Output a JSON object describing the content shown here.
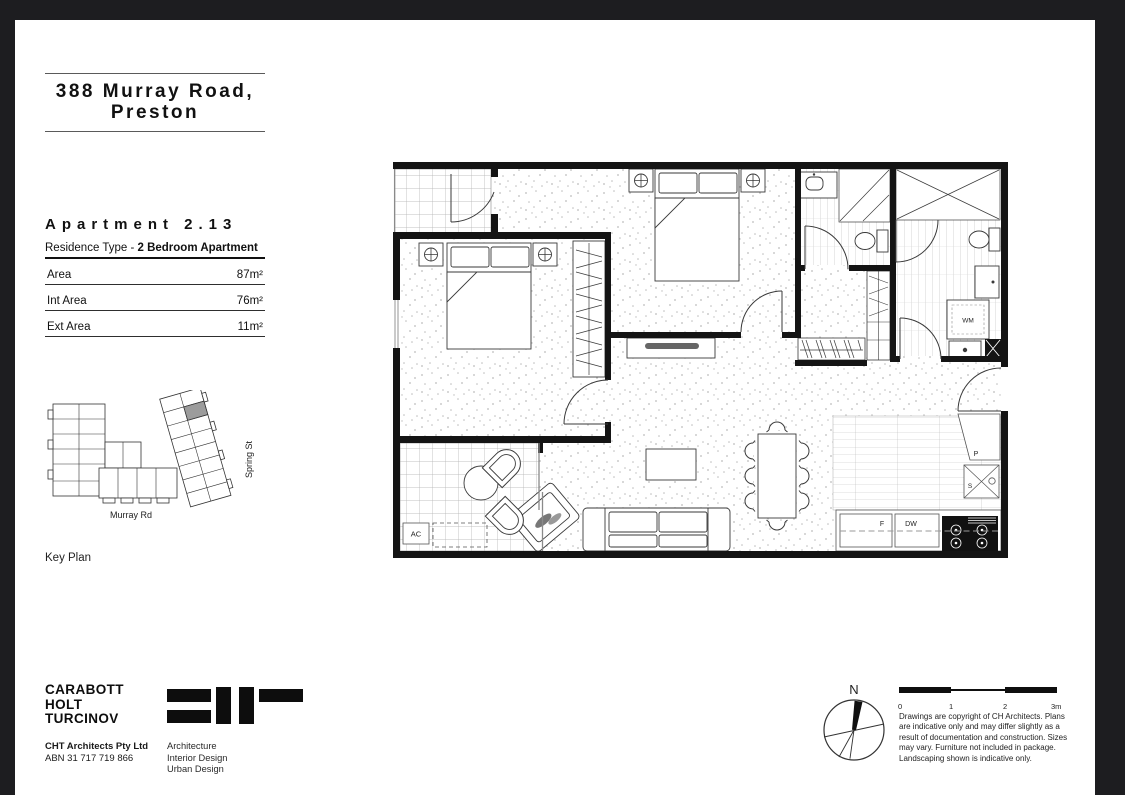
{
  "page": {
    "background": "#1d1d20",
    "paper": "#ffffff"
  },
  "title_block": {
    "line1": "388 Murray Road,",
    "line2": "Preston"
  },
  "apartment": {
    "name": "Apartment 2.13",
    "residence_label": "Residence Type - ",
    "residence_value": "2 Bedroom Apartment",
    "metrics": [
      {
        "label": "Area",
        "value": "87m²"
      },
      {
        "label": "Int Area",
        "value": "76m²"
      },
      {
        "label": "Ext Area",
        "value": "11m²"
      }
    ]
  },
  "key_plan": {
    "caption": "Key Plan",
    "street_bottom": "Murray Rd",
    "street_right": "Spring St",
    "highlight_color": "#9c9c9c"
  },
  "floor_plan": {
    "labels": {
      "ac": "AC",
      "washing_machine": "WM",
      "fridge": "F",
      "dishwasher": "DW",
      "pantry": "P",
      "sink": "S"
    }
  },
  "footer": {
    "firm_lines": [
      "CARABOTT",
      "HOLT",
      "TURCINOV"
    ],
    "company": "CHT Architects Pty Ltd",
    "abn": "ABN 31 717 719 866",
    "services": [
      "Architecture",
      "Interior Design",
      "Urban Design"
    ],
    "north_label": "N",
    "scale_ticks": [
      "0",
      "1",
      "2",
      "3m"
    ],
    "disclaimer_lines": [
      "Drawings are copyright of CH Architects. Plans",
      "are indicative only and may differ slightly as a",
      "result of documentation and construction. Sizes",
      "may vary.  Furniture not included in package.",
      "Landscaping shown is indicative only."
    ]
  }
}
